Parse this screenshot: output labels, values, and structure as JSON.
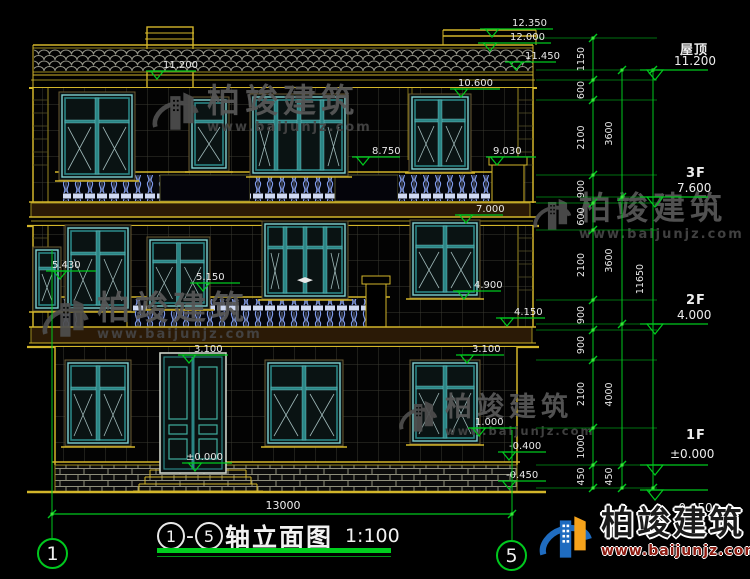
{
  "title_block": {
    "axis_start": "1",
    "separator": "-",
    "axis_end": "5",
    "title": "轴立面图",
    "scale": "1:100"
  },
  "axis_bubbles": {
    "left": "1",
    "right": "5"
  },
  "bottom_dimension": {
    "value": "13000"
  },
  "watermark": {
    "brand": "柏竣建筑",
    "url": "www.baijunjz.com"
  },
  "logo_block": {
    "brand": "柏竣建筑",
    "url": "www.baijunjz.com"
  },
  "floor_levels": [
    {
      "name": "屋顶",
      "elev": "11.200",
      "ly": 70
    },
    {
      "name": "3F",
      "elev": "7.600",
      "ly": 197
    },
    {
      "name": "2F",
      "elev": "4.000",
      "ly": 324
    },
    {
      "name": "1F",
      "elev": "±0.000",
      "ly": 465
    },
    {
      "name": "",
      "elev": "-0.450",
      "ly": 490
    }
  ],
  "elevation_markers": [
    {
      "label": "12.350",
      "tx": 512,
      "ty": 26,
      "lx1": 480,
      "lx2": 553,
      "ly": 29,
      "ax": 492
    },
    {
      "label": "12.000",
      "tx": 510,
      "ty": 40,
      "lx1": 478,
      "lx2": 551,
      "ly": 43,
      "ax": 490
    },
    {
      "label": "11.450",
      "tx": 525,
      "ty": 59,
      "lx1": 505,
      "lx2": 556,
      "ly": 62,
      "ax": 516
    },
    {
      "label": "11.200",
      "tx": 163,
      "ty": 68,
      "lx1": 146,
      "lx2": 196,
      "ly": 71,
      "ax": 157
    },
    {
      "label": "10.600",
      "tx": 458,
      "ty": 86,
      "lx1": 450,
      "lx2": 500,
      "ly": 89,
      "ax": 461
    },
    {
      "label": "9.030",
      "tx": 493,
      "ty": 154,
      "lx1": 486,
      "lx2": 536,
      "ly": 157,
      "ax": 497
    },
    {
      "label": "8.750",
      "tx": 372,
      "ty": 154,
      "lx1": 352,
      "lx2": 400,
      "ly": 157,
      "ax": 363
    },
    {
      "label": "7.000",
      "tx": 476,
      "ty": 212,
      "lx1": 455,
      "lx2": 503,
      "ly": 215,
      "ax": 466
    },
    {
      "label": "5.430",
      "tx": 52,
      "ty": 268,
      "lx1": 46,
      "lx2": 96,
      "ly": 271,
      "ax": 60
    },
    {
      "label": "5.150",
      "tx": 196,
      "ty": 280,
      "lx1": 190,
      "lx2": 240,
      "ly": 283,
      "ax": 203
    },
    {
      "label": "4.900",
      "tx": 474,
      "ty": 288,
      "lx1": 453,
      "lx2": 501,
      "ly": 291,
      "ax": 464
    },
    {
      "label": "4.150",
      "tx": 514,
      "ty": 315,
      "lx1": 496,
      "lx2": 545,
      "ly": 318,
      "ax": 507
    },
    {
      "label": "3.100",
      "tx": 194,
      "ty": 352,
      "lx1": 178,
      "lx2": 228,
      "ly": 355,
      "ax": 189
    },
    {
      "label": "3.100",
      "tx": 472,
      "ty": 352,
      "lx1": 456,
      "lx2": 504,
      "ly": 355,
      "ax": 467
    },
    {
      "label": "1.000",
      "tx": 475,
      "ty": 425,
      "lx1": 468,
      "lx2": 516,
      "ly": 428,
      "ax": 479
    },
    {
      "label": "±0.000",
      "tx": 186,
      "ty": 460,
      "lx1": 182,
      "lx2": 232,
      "ly": 463,
      "ax": 195
    },
    {
      "label": "-0.400",
      "tx": 509,
      "ty": 449,
      "lx1": 498,
      "lx2": 546,
      "ly": 452,
      "ax": 509
    },
    {
      "label": "-0.450",
      "tx": 506,
      "ty": 478,
      "lx1": 498,
      "lx2": 546,
      "ly": 481,
      "ax": 509
    }
  ],
  "dim_chains": [
    {
      "x": 593,
      "label_x": 584,
      "ticks": [
        38,
        80,
        100,
        175,
        203,
        230,
        300,
        330,
        360,
        428,
        465,
        488
      ],
      "values": [
        "1150",
        "600",
        "2100",
        "900",
        "600",
        "2100",
        "900",
        "900",
        "2100",
        "1000",
        "450"
      ]
    },
    {
      "x": 622,
      "label_x": 612,
      "ticks": [
        70,
        197,
        324,
        465,
        488
      ],
      "values": [
        "3600",
        "3600",
        "4000",
        "450"
      ]
    },
    {
      "x": 653,
      "label_x": 643,
      "ticks": [
        70,
        488
      ],
      "values": [
        "11650"
      ]
    }
  ],
  "extension_line_ys": [
    38,
    70,
    80,
    100,
    175,
    197,
    203,
    230,
    300,
    324,
    330,
    360,
    428,
    465,
    488
  ],
  "colors": {
    "dim_green": "#00c81e",
    "line_yellow": "#9b8a20",
    "accent_yellow": "#d2b52a",
    "frame_teal": "#2a8585",
    "frame_teal_light": "#7fd0d0",
    "pane_diag": "#9fb9b9",
    "baluster_blue": "#7f9bec",
    "slab_brown": "#2b1a06",
    "text_white": "#e9e9e9",
    "watermark_gray": "#585858",
    "logo_blue": "#1f6cc0",
    "logo_orange": "#f5a21b",
    "url_red": "#8c1a10"
  }
}
